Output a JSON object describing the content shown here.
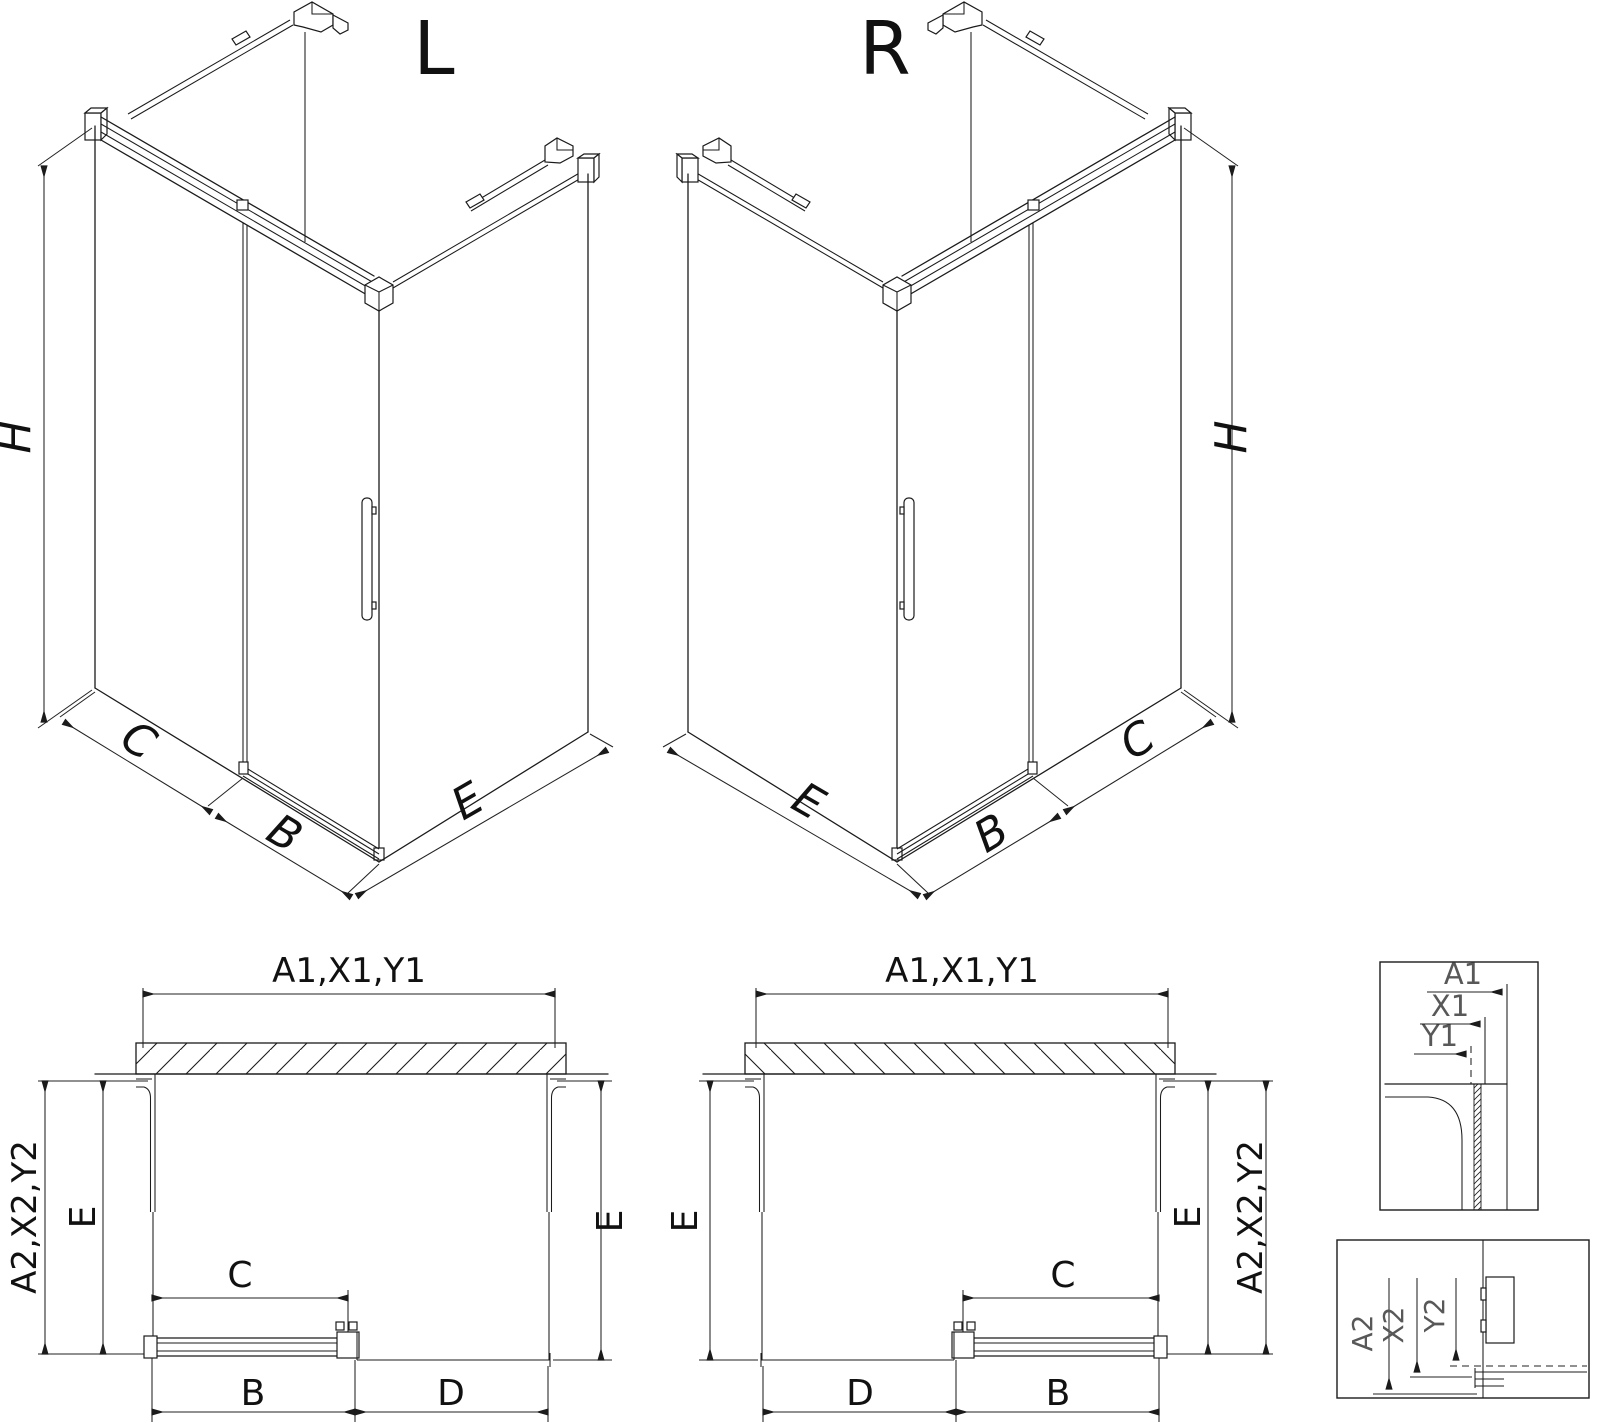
{
  "iso_left": {
    "title": "L",
    "height": "H",
    "panel": "C",
    "door": "B",
    "side": "E"
  },
  "iso_right": {
    "title": "R",
    "height": "H",
    "panel": "C",
    "door": "B",
    "side": "E"
  },
  "plan_left": {
    "width": "A1,X1,Y1",
    "depth": "A2,X2,Y2",
    "side_left": "E",
    "side_right": "E",
    "panel": "C",
    "door": "B",
    "fixed": "D"
  },
  "plan_right": {
    "width": "A1,X1,Y1",
    "depth": "A2,X2,Y2",
    "side_left": "E",
    "side_right": "E",
    "panel": "C",
    "door": "B",
    "fixed": "D"
  },
  "detail_width": {
    "overall": "A1",
    "mid": "X1",
    "inner": "Y1"
  },
  "detail_depth": {
    "overall": "A2",
    "mid": "X2",
    "inner": "Y2"
  }
}
